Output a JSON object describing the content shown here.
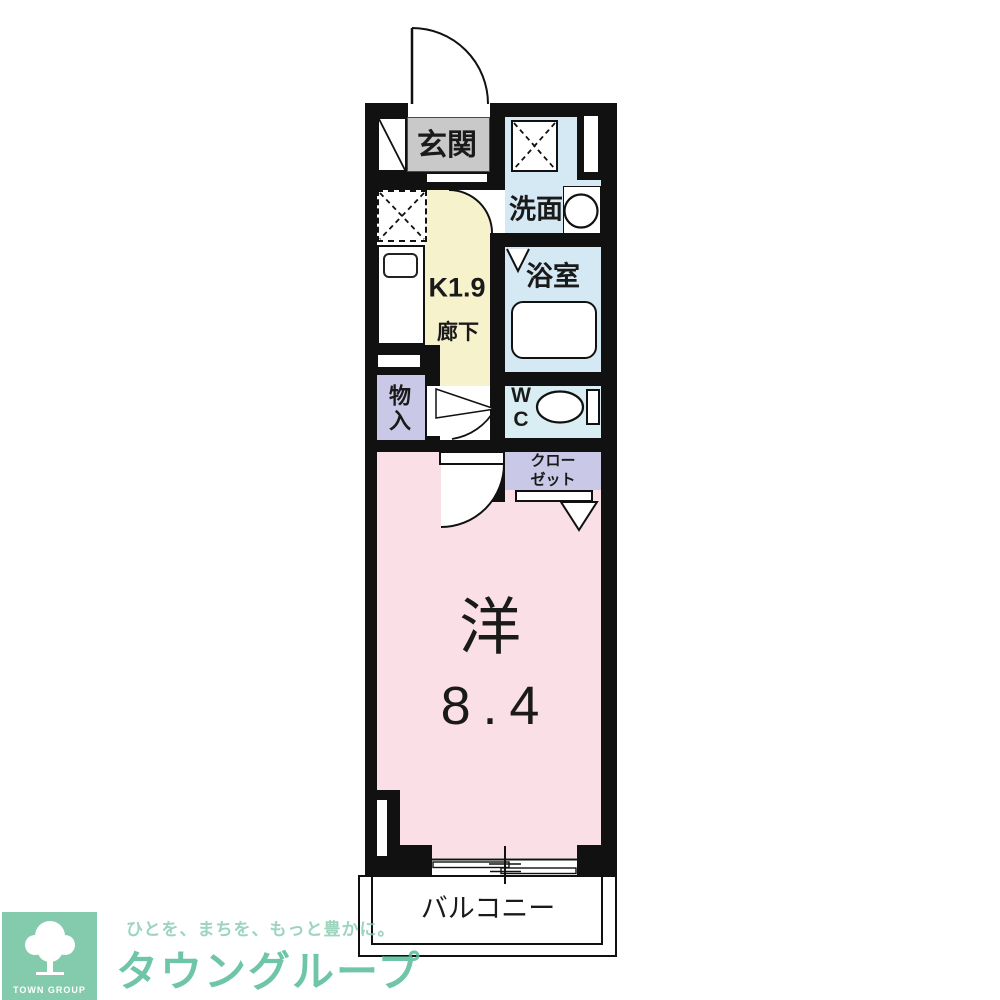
{
  "floorplan": {
    "rooms": {
      "genkan": {
        "label": "玄関"
      },
      "washroom": {
        "label": "洗面"
      },
      "bathroom": {
        "label": "浴室"
      },
      "kitchen": {
        "label": "K1.9",
        "corridor_label": "廊下"
      },
      "storage": {
        "label": "物\n入"
      },
      "wc": {
        "label": "W\nC"
      },
      "closet": {
        "label": "クロー\nゼット"
      },
      "main_room": {
        "label": "洋",
        "size": "8.4"
      },
      "balcony": {
        "label": "バルコニー"
      }
    },
    "colors": {
      "wall": "#111111",
      "genkan_gray": "#c9c9c9",
      "kitchen_yellow": "#f6f2cc",
      "wet_area_blue": "#d4e9f3",
      "wc_blue": "#d9eef2",
      "closet_lavender": "#c9c8e7",
      "room_pink": "#fbdfe7"
    }
  },
  "logo": {
    "brand": "タウングループ",
    "tagline": "ひとを、まちを、もっと豊かに。",
    "mark_text": "TOWN GROUP",
    "green": "#57bb9a"
  }
}
